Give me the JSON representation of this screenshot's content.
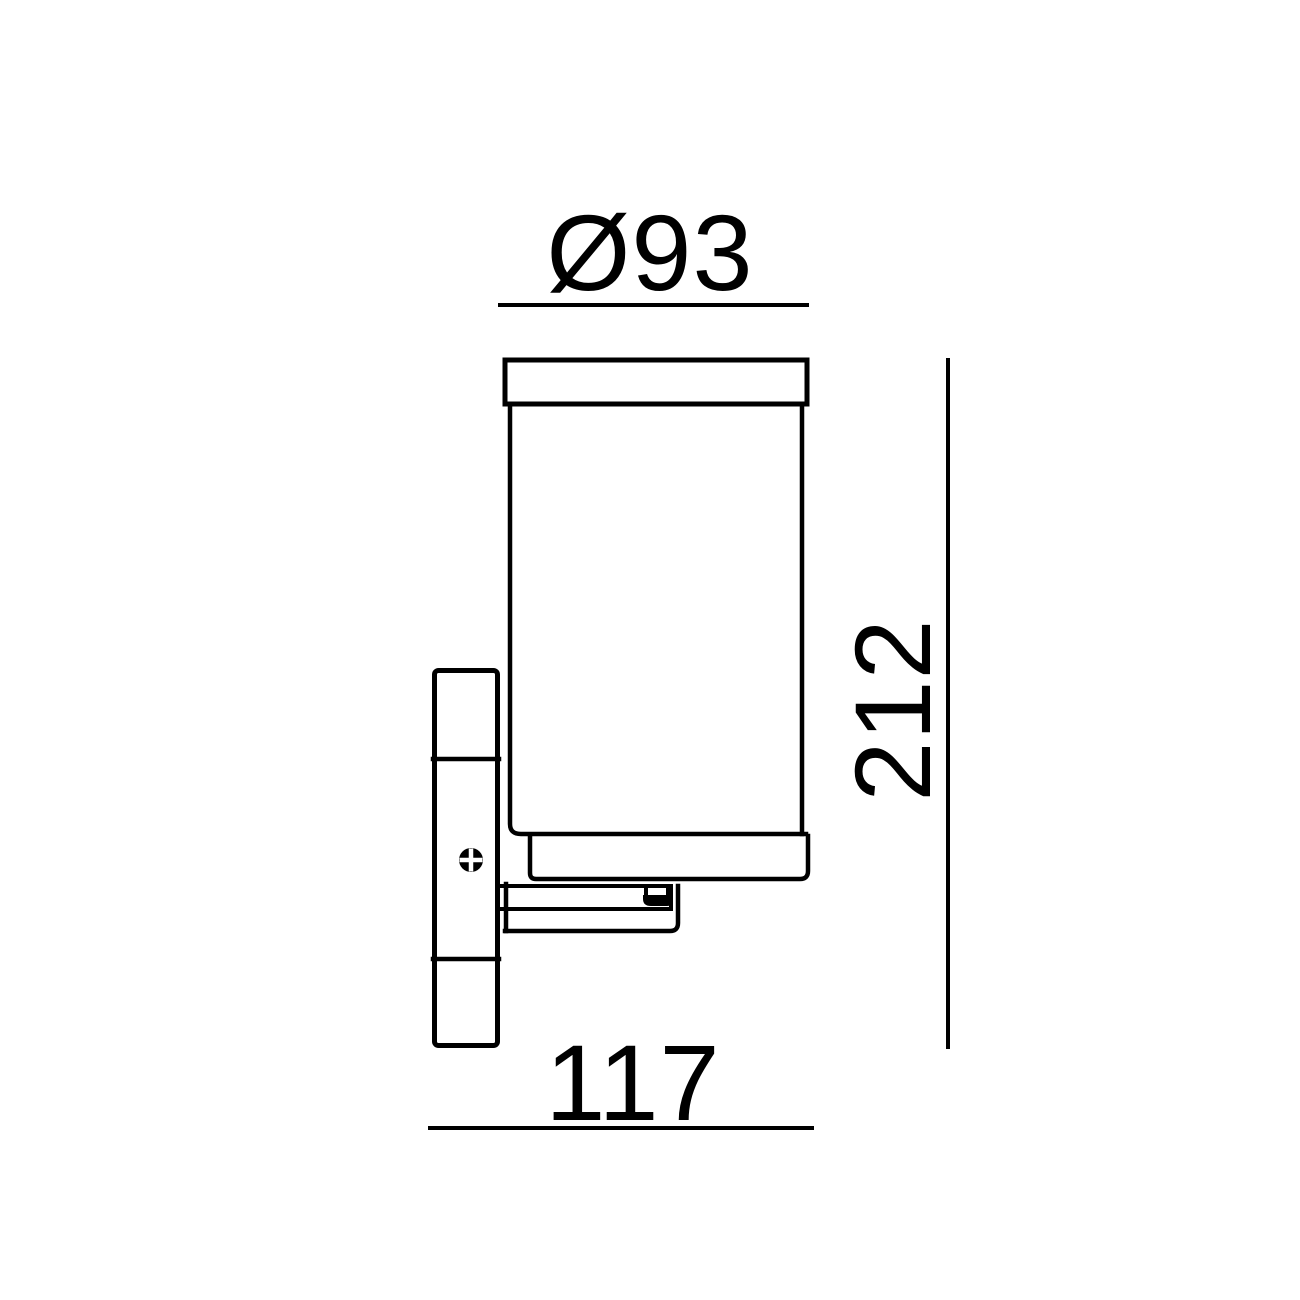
{
  "page": {
    "background_color": "#ffffff"
  },
  "drawing": {
    "type": "technical-dimension-diagram",
    "subject": "wall-mounted cylindrical light fixture, side elevation",
    "line_color": "#000000",
    "dimensions": [
      {
        "id": "diameter",
        "label": "Ø93",
        "position": "top"
      },
      {
        "id": "height",
        "label": "212",
        "position": "right"
      },
      {
        "id": "depth",
        "label": "117",
        "position": "bottom"
      }
    ],
    "icons": {
      "screw_head": "phillips-screw-head"
    }
  }
}
